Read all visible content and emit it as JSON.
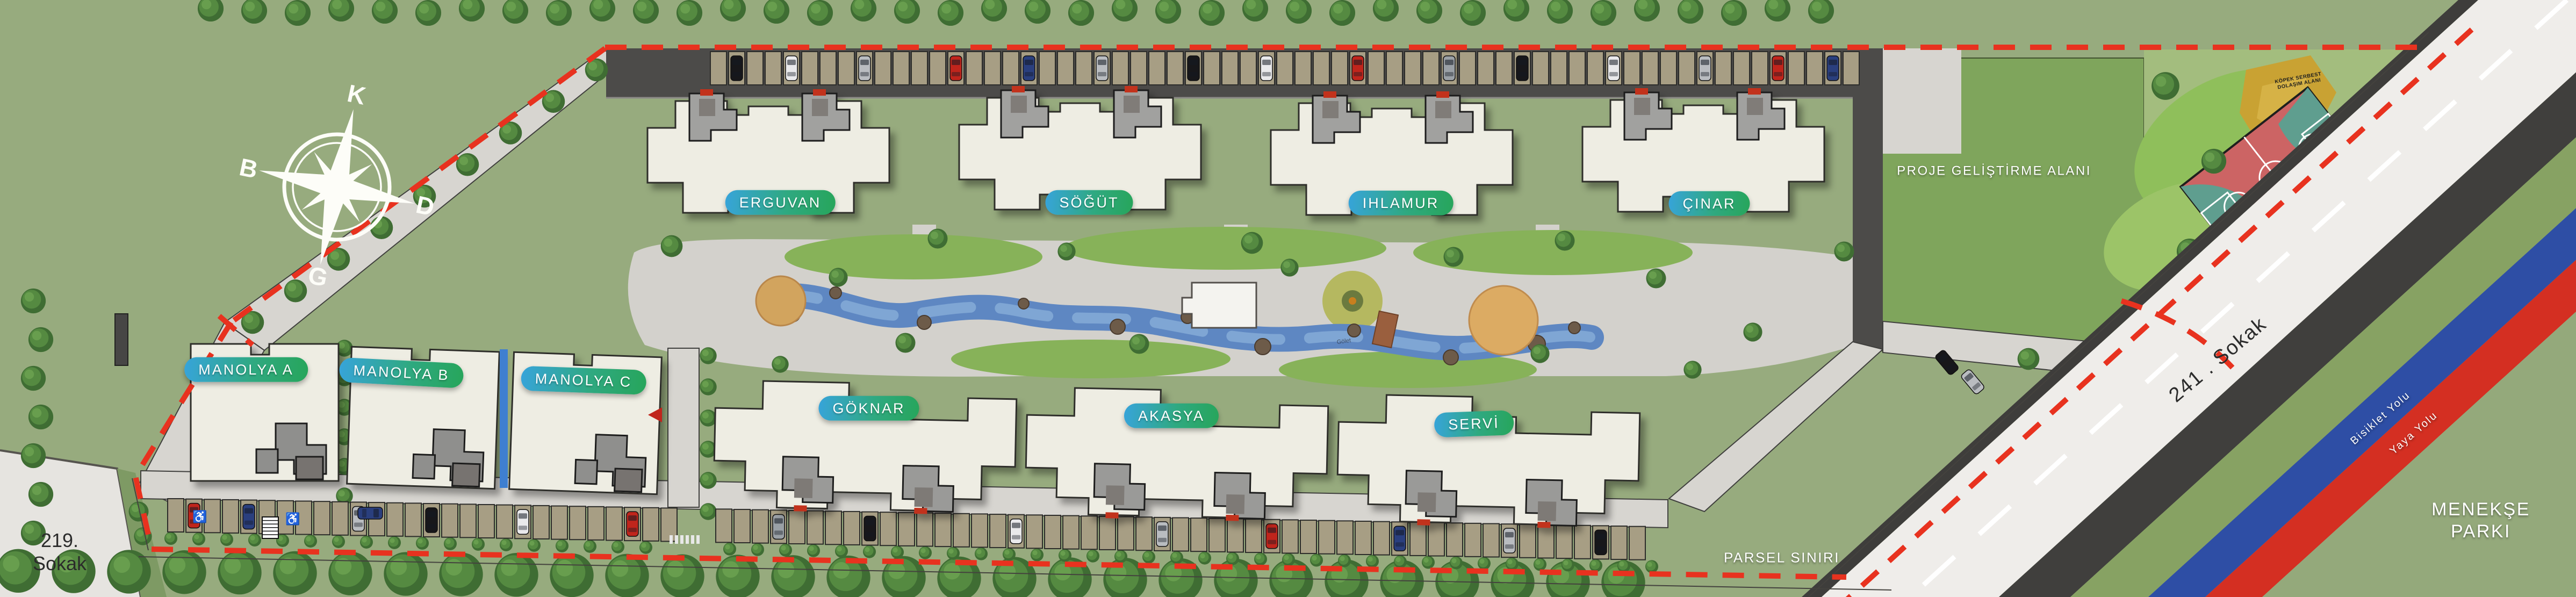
{
  "compass": {
    "north_label": "K",
    "east_label": "D",
    "south_label": "G",
    "west_label": "B"
  },
  "buildings": [
    {
      "name": "ERGUVAN"
    },
    {
      "name": "SÖĞÜT"
    },
    {
      "name": "IHLAMUR"
    },
    {
      "name": "ÇINAR"
    },
    {
      "name": "GÖKNAR"
    },
    {
      "name": "AKASYA"
    },
    {
      "name": "SERVİ"
    },
    {
      "name": "MANOLYA A"
    },
    {
      "name": "MANOLYA B"
    },
    {
      "name": "MANOLYA C"
    }
  ],
  "labels": {
    "project_area": "PROJE GELİŞTİRME ALANI",
    "parcel_boundary": "PARSEL SINIRI",
    "park_line1": "MENEKŞE",
    "park_line2": "PARKI",
    "street_south_line1": "219.",
    "street_south_line2": "Sokak",
    "street_east": "241 . Sokak",
    "bike_path": "Bisiklet Yolu",
    "pedestrian_path": "Yaya Yolu",
    "dog_area_line1": "KÖPEK SERBEST",
    "dog_area_line2": "DOLAŞIM ALANI",
    "pond": "Gölet"
  },
  "colors": {
    "grass": "#97ab7e",
    "project_area_green": "#7fa55c",
    "playground_green": "#a3bd7e",
    "road_dark": "#4c4b49",
    "road_light": "#d7d5d0",
    "street_white": "#efedea",
    "building_cream": "#eeede3",
    "roof_gray": "#a1a19f",
    "water_blue": "#5e87c2",
    "label_gradient_start": "#37a4da",
    "label_gradient_end": "#27a55b",
    "boundary_red": "#e8321f",
    "bike_lane_blue": "#2e4ea5",
    "pedestrian_lane_red": "#d42f22",
    "court_red": "#cc6464",
    "court_teal": "#5f9e8f",
    "dog_area_yellow": "#c9a233",
    "parking_tan": "#a79e84",
    "plaza_tan": "#d2a45e"
  }
}
